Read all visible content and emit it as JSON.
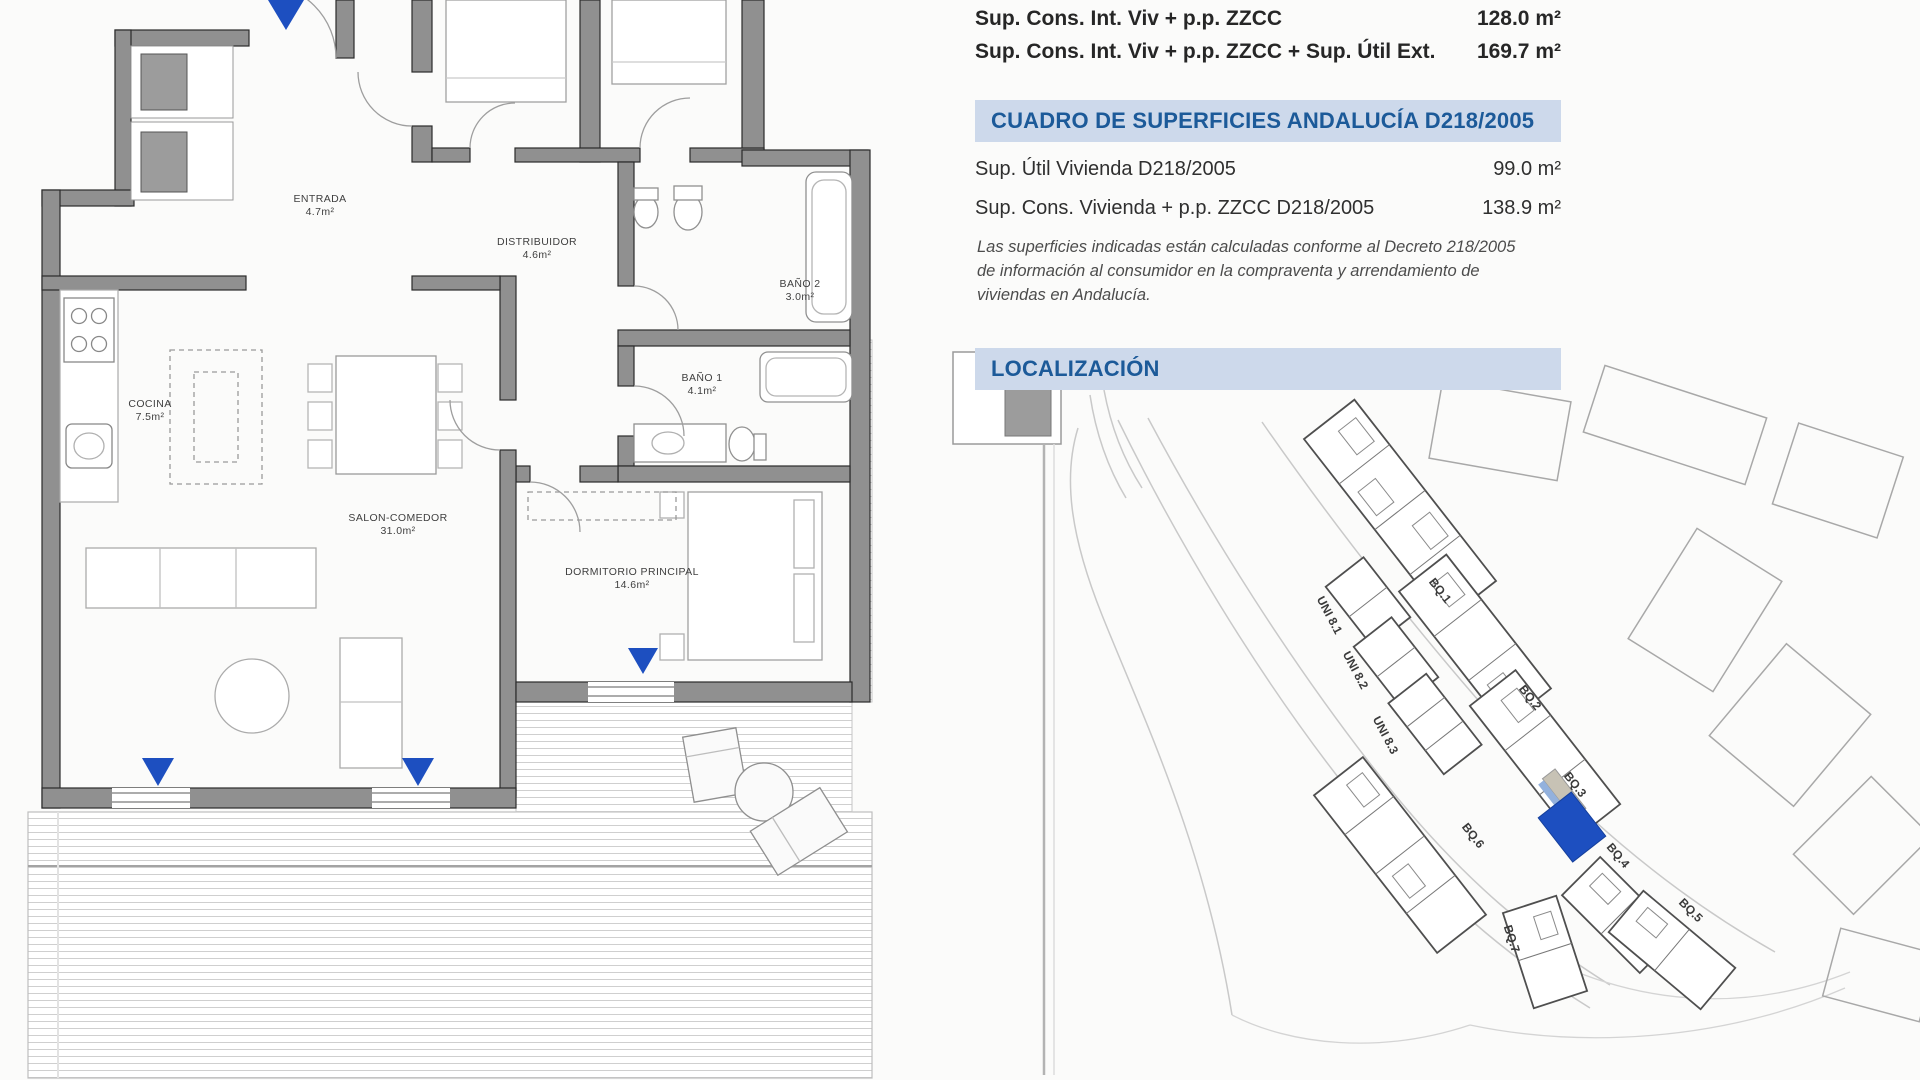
{
  "surface_summary": {
    "rows": [
      {
        "label": "Sup. Cons. Int. Viv + p.p. ZZCC",
        "value": "128.0 m²"
      },
      {
        "label": "Sup. Cons. Int. Viv + p.p. ZZCC + Sup. Útil Ext.",
        "value": "169.7 m²"
      }
    ]
  },
  "cuadro": {
    "title": "CUADRO DE SUPERFICIES ANDALUCÍA D218/2005",
    "rows": [
      {
        "label": "Sup. Útil Vivienda D218/2005",
        "value": "99.0 m²"
      },
      {
        "label": "Sup. Cons. Vivienda + p.p. ZZCC D218/2005",
        "value": "138.9 m²"
      }
    ],
    "note": "Las superficies indicadas están calculadas conforme al Decreto 218/2005 de información al consumidor en la compraventa y arrendamiento de viviendas en Andalucía."
  },
  "localizacion": {
    "title": "LOCALIZACIÓN"
  },
  "plan": {
    "rooms": [
      {
        "name": "ENTRADA",
        "area": "4.7m²"
      },
      {
        "name": "DISTRIBUIDOR",
        "area": "4.6m²"
      },
      {
        "name": "BAÑO 2",
        "area": "3.0m²"
      },
      {
        "name": "COCINA",
        "area": "7.5m²"
      },
      {
        "name": "SALON-COMEDOR",
        "area": "31.0m²"
      },
      {
        "name": "BAÑO 1",
        "area": "4.1m²"
      },
      {
        "name": "DORMITORIO PRINCIPAL",
        "area": "14.6m²"
      }
    ]
  },
  "map": {
    "labels": [
      {
        "text": "BQ.1"
      },
      {
        "text": "BQ.2"
      },
      {
        "text": "BQ.3"
      },
      {
        "text": "BQ.4"
      },
      {
        "text": "BQ.5"
      },
      {
        "text": "BQ.6"
      },
      {
        "text": "BQ.7"
      },
      {
        "text": "UNI 8.1"
      },
      {
        "text": "UNI 8.2"
      },
      {
        "text": "UNI 8.3"
      }
    ]
  },
  "colors": {
    "header_bar_bg": "#cdd9eb",
    "header_text": "#1c5a99",
    "accent_blue": "#1d4fc0",
    "wall_gray": "#909090"
  }
}
